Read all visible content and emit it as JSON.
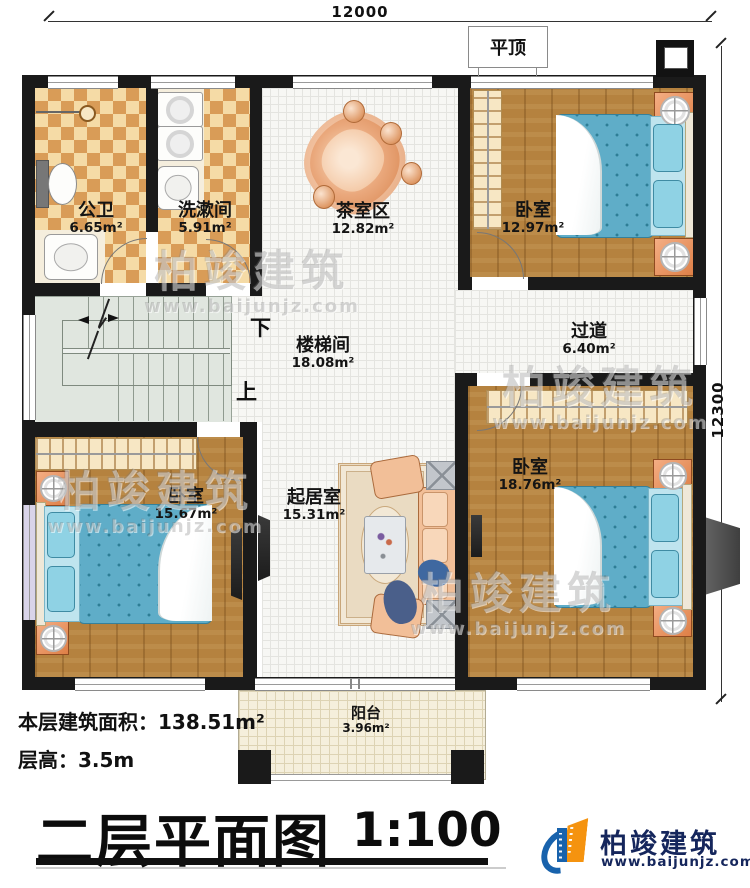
{
  "dimensions": {
    "width": "12000",
    "height": "12300"
  },
  "annotations": {
    "flat_roof": "平顶",
    "stairs_down": "下",
    "stairs_up": "上"
  },
  "rooms": [
    {
      "name": "公卫",
      "area": "6.65m²"
    },
    {
      "name": "洗漱间",
      "area": "5.91m²"
    },
    {
      "name": "茶室区",
      "area": "12.82m²"
    },
    {
      "name": "卧室",
      "area": "12.97m²"
    },
    {
      "name": "过道",
      "area": "6.40m²"
    },
    {
      "name": "楼梯间",
      "area": "18.08m²"
    },
    {
      "name": "卧室",
      "area": "15.67m²"
    },
    {
      "name": "起居室",
      "area": "15.31m²"
    },
    {
      "name": "卧室",
      "area": "18.76m²"
    },
    {
      "name": "阳台",
      "area": "3.96m²"
    }
  ],
  "info": {
    "area_label": "本层建筑面积：",
    "area_value": "138.51m²",
    "height_label": "层高：",
    "height_value": "3.5m"
  },
  "title_block": {
    "title": "二层平面图",
    "scale": "1:100"
  },
  "brand": {
    "name": "柏竣建筑",
    "website": "www.baijunjz.com"
  },
  "watermark": {
    "name": "柏竣建筑",
    "website": "www.baijunjz.com"
  },
  "colors": {
    "wall": "#1a1a1a",
    "wood_floor": "#b5823f",
    "checker_dark": "#d99c57",
    "checker_light": "#f5dba6",
    "bed_blue": "#5fadc8",
    "nightstand_orange": "#e89058",
    "sofa_salmon": "#f2bf98",
    "stair_green": "#e0e6df",
    "balcony_cream": "#f5efdc",
    "logo_blue": "#1862ac",
    "logo_orange": "#f5930f",
    "logo_text": "#15265c"
  }
}
